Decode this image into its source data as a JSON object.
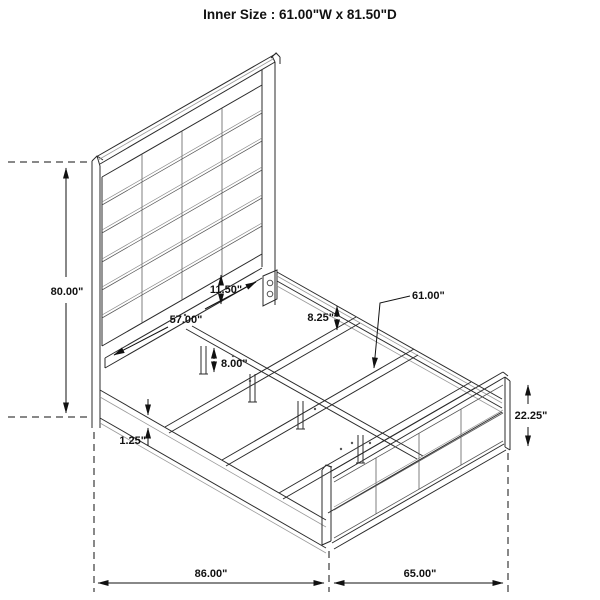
{
  "title": "Inner Size : 61.00\"W x 81.50\"D",
  "dimensions": {
    "headboard_height": "80.00\"",
    "headboard_panel_width": "57.00\"",
    "panel_to_rail_gap": "11.50\"",
    "side_rail_height": "8.25\"",
    "inner_slat_width": "61.00\"",
    "support_leg_height": "8.00\"",
    "rail_lip_thickness": "1.25\"",
    "footboard_height": "22.25\"",
    "overall_length": "86.00\"",
    "overall_width": "65.00\""
  }
}
